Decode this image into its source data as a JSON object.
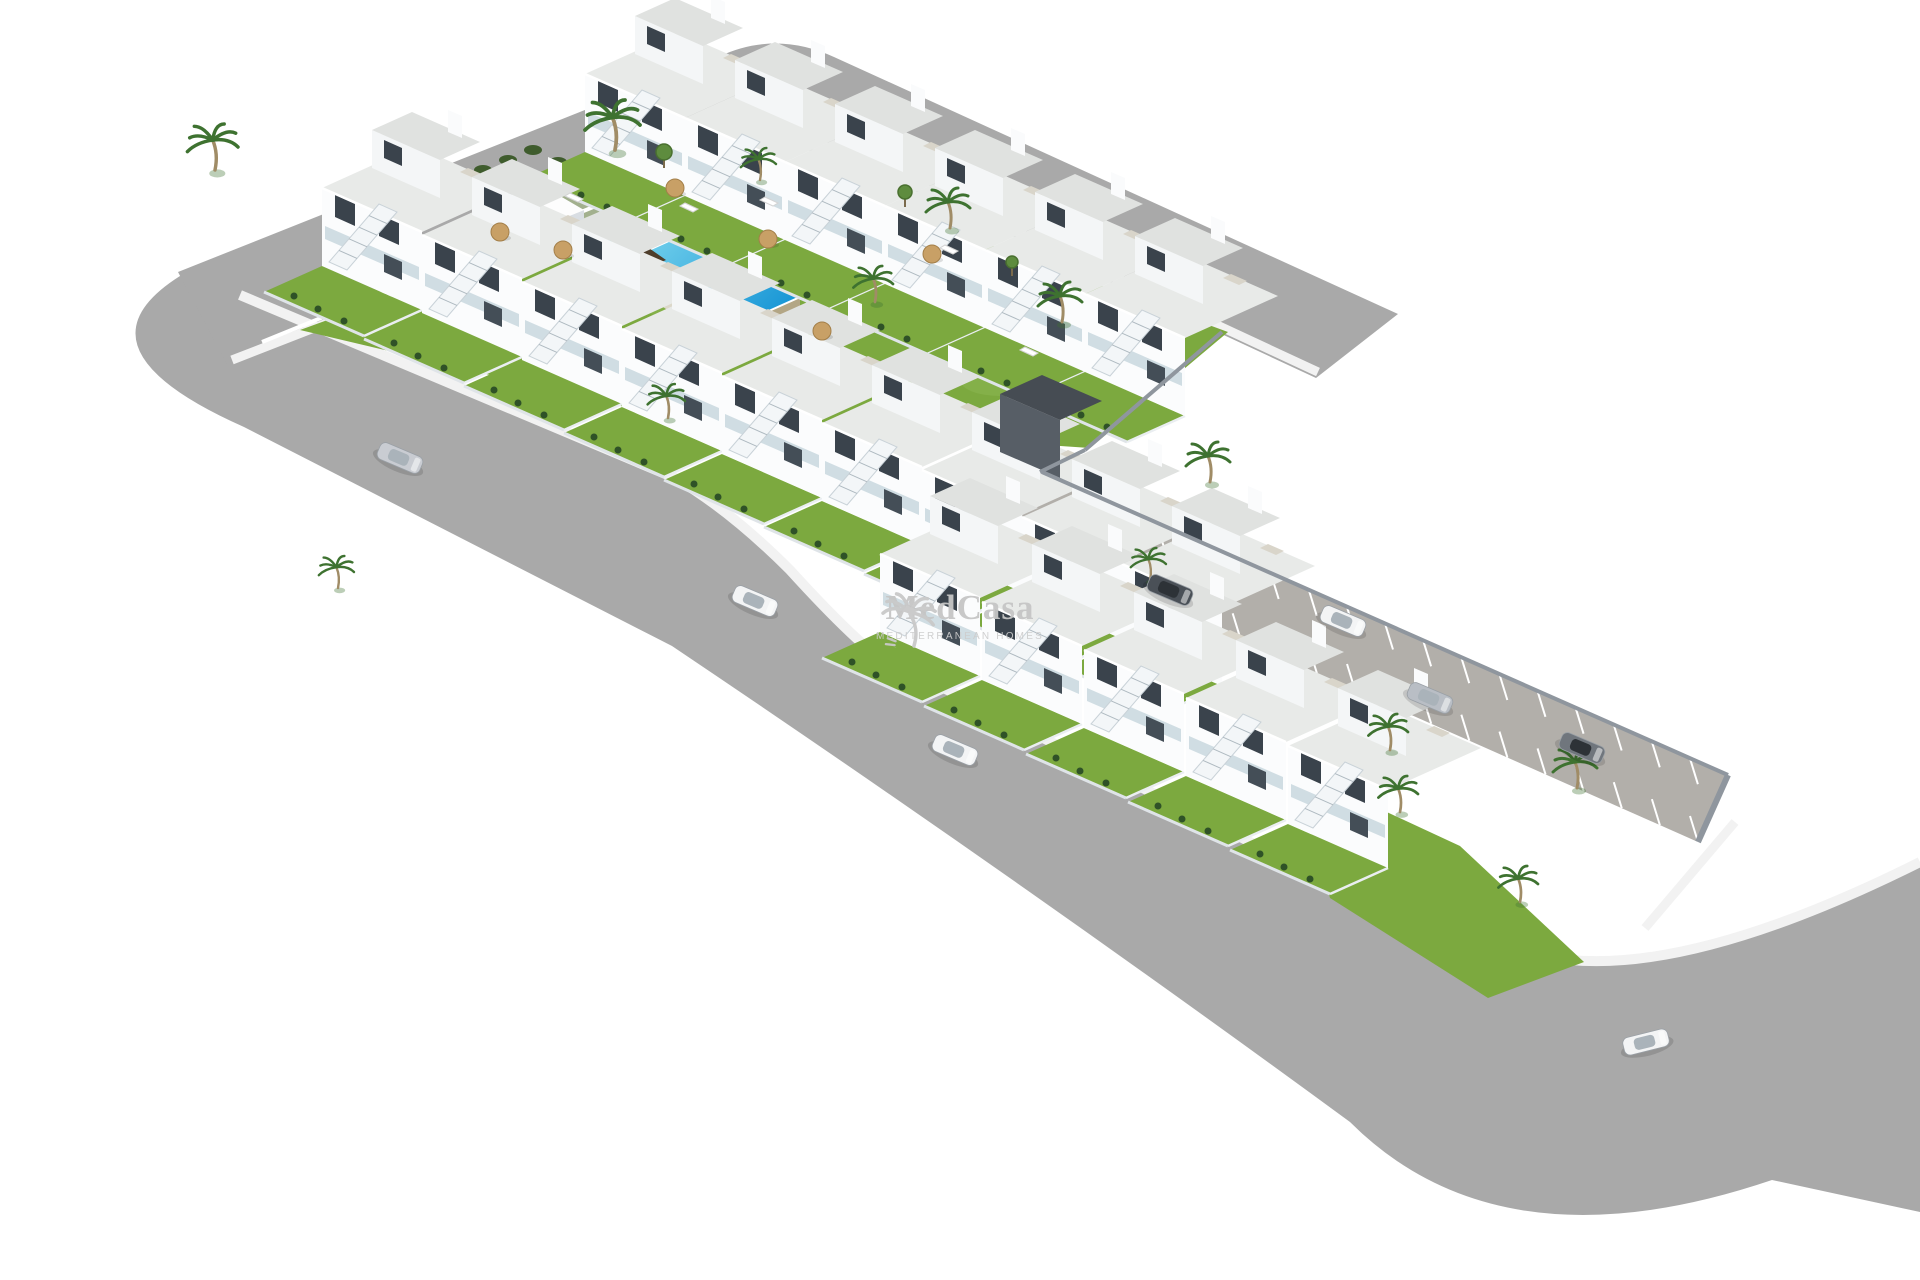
{
  "meta": {
    "kind": "3d-architectural-site-render",
    "subject": "Aerial render of an L-shaped residential development of white townhouses with communal pool, gardens, perimeter roads and parking",
    "width": 1920,
    "height": 1280,
    "background": "#ffffff"
  },
  "watermark": {
    "brand": "MedCasa",
    "tagline": "MEDITERRANEAN HOMES",
    "color": "#c6c6c6"
  },
  "palette": {
    "road": "#a9a9a9",
    "roadDark": "#9f9f9f",
    "parkingRoad": "#b2afaa",
    "sidewalk": "#f2f2f2",
    "grass": "#7ca93f",
    "grassLight": "#95bc5c",
    "facade": "#fbfcfd",
    "roof": "#e8eae8",
    "window": "#3a434c",
    "balcony": "#cbd9e0",
    "wall": "#8f969e",
    "fence": "#dfe4e8",
    "poolDeck": "#dcd8ca",
    "poolWaterLight": "#7fd8ef",
    "poolWaterDeep": "#1b98d6",
    "poolWall": "#b3a685",
    "wood": "#4e3e2b",
    "palm": "#3e7230",
    "trunk": "#a08c66",
    "umbrella": "#c8a066"
  },
  "scene": {
    "roads": {
      "top": "M178 272 L718 57 Q775 30 834 57 L1398 314 L1316 378 L852 162 Q804 140 756 160 L228 366 Z",
      "bottom": "M240 295 L675 478 Q730 510 790 570 Q840 625 872 652 L1290 862 Q1450 945 1570 960 Q1700 972 1920 862 L1920 1212 L1772 1180 Q1500 1272 1350 1122 Q1020 880 672 646 L244 427 Q66 348 180 276 Z"
    },
    "sidewalks": [
      {
        "d": "M232 360 L756 156 Q806 134 854 156 L1318 372",
        "w": 9
      },
      {
        "d": "M240 295 L675 478 Q730 510 790 570 Q840 625 872 652 L1290 862 Q1450 945 1570 960 Q1700 972 1920 862",
        "w": 10
      },
      {
        "d": "M1735 822 L1645 928",
        "w": 9
      }
    ],
    "parking": {
      "poly": [
        [
          1042,
          472
        ],
        [
          1728,
          775
        ],
        [
          1698,
          842
        ],
        [
          1012,
          538
        ]
      ],
      "bayDir": [
        8,
        26
      ],
      "bayLen": 1.0,
      "neBays": 18,
      "swBaysFrom": 6,
      "endWall": [
        [
          1728,
          775
        ],
        [
          1698,
          842
        ]
      ]
    },
    "walls": [
      [
        1222,
        332,
        1085,
        450
      ],
      [
        1085,
        450,
        1040,
        472
      ],
      [
        1042,
        472,
        1728,
        775
      ]
    ],
    "lawns": [
      [
        [
          300,
          330
        ],
        [
          764,
          162
        ],
        [
          1228,
          332
        ],
        [
          1090,
          448
        ],
        [
          680,
          420
        ]
      ],
      [
        [
          1292,
          768
        ],
        [
          1460,
          846
        ],
        [
          1584,
          962
        ],
        [
          1488,
          998
        ],
        [
          1330,
          898
        ]
      ]
    ],
    "lawnPatches": [
      [
        700,
        300,
        60,
        24
      ],
      [
        560,
        210,
        42,
        16
      ],
      [
        900,
        270,
        50,
        20
      ],
      [
        1000,
        380,
        40,
        16
      ],
      [
        470,
        260,
        36,
        14
      ]
    ],
    "nwFence": [
      262,
      342,
      748,
      144
    ],
    "hedges": [
      [
        458,
        180
      ],
      [
        483,
        170
      ],
      [
        508,
        160
      ],
      [
        533,
        150
      ],
      [
        558,
        162
      ],
      [
        590,
        168
      ]
    ],
    "pool": {
      "deck": [
        [
          585,
          252
        ],
        [
          693,
          204
        ],
        [
          818,
          292
        ],
        [
          710,
          340
        ]
      ],
      "water": [
        [
          622,
          262
        ],
        [
          700,
          227
        ],
        [
          800,
          297
        ],
        [
          722,
          332
        ]
      ],
      "kids": [
        [
          588,
          240
        ],
        [
          622,
          225
        ],
        [
          650,
          240
        ],
        [
          616,
          255
        ]
      ],
      "infinity": [
        [
          800,
          297
        ],
        [
          722,
          332
        ],
        [
          722,
          354
        ],
        [
          800,
          319
        ]
      ],
      "steps": [
        [
          [
            693,
            230
          ],
          [
            711,
            222
          ],
          [
            719,
            228
          ],
          [
            701,
            236
          ]
        ],
        [
          [
            700,
            237
          ],
          [
            718,
            229
          ],
          [
            726,
            235
          ],
          [
            708,
            243
          ]
        ]
      ],
      "wood": [
        [
          [
            690,
            222
          ],
          [
            738,
            200
          ],
          [
            758,
            214
          ],
          [
            710,
            236
          ]
        ],
        [
          [
            598,
            268
          ],
          [
            646,
            246
          ],
          [
            666,
            260
          ],
          [
            618,
            282
          ]
        ],
        [
          [
            700,
            330
          ],
          [
            748,
            308
          ],
          [
            768,
            322
          ],
          [
            720,
            344
          ]
        ]
      ],
      "sign": [
        620,
        190
      ]
    },
    "structure": {
      "top": [
        [
          506,
          218
        ],
        [
          560,
          196
        ],
        [
          584,
          210
        ],
        [
          530,
          232
        ]
      ],
      "front": [
        [
          530,
          232
        ],
        [
          584,
          210
        ],
        [
          584,
          222
        ],
        [
          530,
          244
        ]
      ]
    },
    "darkBuilding": {
      "face": [
        [
          1000,
          452
        ],
        [
          1060,
          478
        ],
        [
          1060,
          420
        ],
        [
          1000,
          394
        ]
      ],
      "roof": [
        [
          1000,
          394
        ],
        [
          1060,
          420
        ],
        [
          1102,
          401
        ],
        [
          1042,
          375
        ]
      ]
    },
    "rows": [
      {
        "name": "north-row",
        "x": 585,
        "y": 152,
        "dx": 100,
        "dy": 44,
        "count": 6
      },
      {
        "name": "west-row",
        "x": 322,
        "y": 266,
        "dx": 100,
        "dy": 47,
        "count": 9
      },
      {
        "name": "south-row",
        "x": 880,
        "y": 632,
        "dx": 102,
        "dy": 48,
        "count": 5
      }
    ],
    "cars": [
      {
        "x": 400,
        "y": 458,
        "rot": 23,
        "body": "#c9ccd2"
      },
      {
        "x": 755,
        "y": 601,
        "rot": 23,
        "body": "#f3f4f5"
      },
      {
        "x": 955,
        "y": 750,
        "rot": 23,
        "body": "#f3f4f5"
      },
      {
        "x": 1170,
        "y": 590,
        "rot": 23,
        "body": "#4a5057"
      },
      {
        "x": 1343,
        "y": 621,
        "rot": 23,
        "body": "#f3f4f5"
      },
      {
        "x": 1430,
        "y": 698,
        "rot": 23,
        "body": "#b9bec5"
      },
      {
        "x": 1582,
        "y": 748,
        "rot": 23,
        "body": "#70767d"
      },
      {
        "x": 1646,
        "y": 1042,
        "rot": -14,
        "body": "#f3f4f5"
      }
    ],
    "palms": [
      [
        215,
        170,
        1.15
      ],
      [
        615,
        150,
        1.25
      ],
      [
        950,
        228,
        1.0
      ],
      [
        1062,
        322,
        1.0
      ],
      [
        875,
        302,
        0.9
      ],
      [
        1210,
        482,
        1.0
      ],
      [
        668,
        418,
        0.85
      ],
      [
        338,
        588,
        0.8
      ],
      [
        1150,
        580,
        0.8
      ],
      [
        1390,
        750,
        0.9
      ],
      [
        1577,
        788,
        1.0
      ],
      [
        1400,
        812,
        0.9
      ],
      [
        1520,
        902,
        0.9
      ],
      [
        760,
        180,
        0.8
      ]
    ],
    "trees": [
      [
        664,
        152,
        8
      ],
      [
        905,
        192,
        7
      ],
      [
        1012,
        262,
        6
      ]
    ],
    "umbrellas": [
      [
        675,
        188
      ],
      [
        563,
        250
      ],
      [
        768,
        239
      ],
      [
        932,
        254
      ],
      [
        822,
        331
      ],
      [
        500,
        232
      ]
    ],
    "loungers": [
      [
        565,
        196
      ],
      [
        680,
        206
      ],
      [
        940,
        248
      ],
      [
        1020,
        350
      ],
      [
        760,
        200
      ]
    ]
  }
}
